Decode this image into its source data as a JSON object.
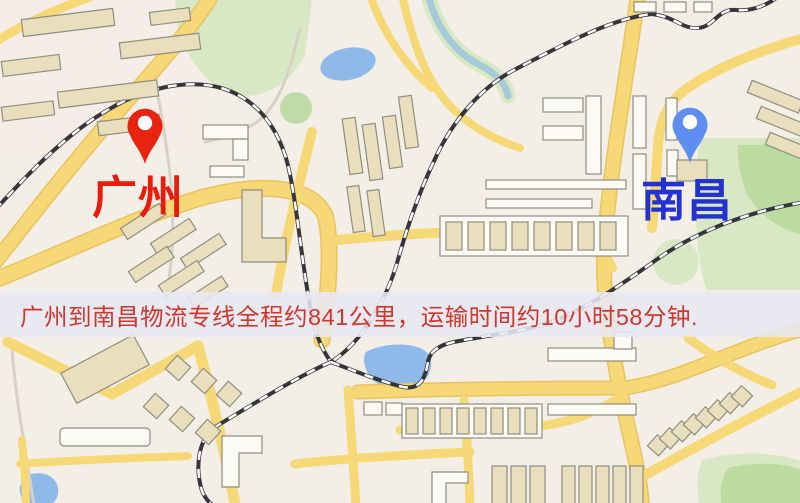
{
  "banner": {
    "text": "广州到南昌物流专线全程约841公里，运输时间约10小时58分钟.",
    "text_color": "#d2372c",
    "background": "rgba(231,232,243,0.87)"
  },
  "markers": {
    "origin": {
      "label": "广州",
      "label_color": "#ea1a0c",
      "pin_color": "#e8230f",
      "icon": "map-pin-icon"
    },
    "destination": {
      "label": "南昌",
      "label_color": "#2432cf",
      "pin_color": "#5d8ef0",
      "icon": "map-pin-icon"
    }
  },
  "map": {
    "colors": {
      "background": "#f4efe6",
      "road": "#f6d877",
      "road_edge": "#eac35f",
      "railway": "#35353b",
      "water": "#8fb9e9",
      "stream": "#a5cbd8",
      "park_light": "#d9e8c4",
      "park_dark": "#b5d89b",
      "building_fill": "#eadfbc",
      "building_stroke": "#8f8e80",
      "building_white": "#fcfaf4",
      "residential": "#f6ebe8",
      "path_minor": "#d7d2c4"
    }
  }
}
